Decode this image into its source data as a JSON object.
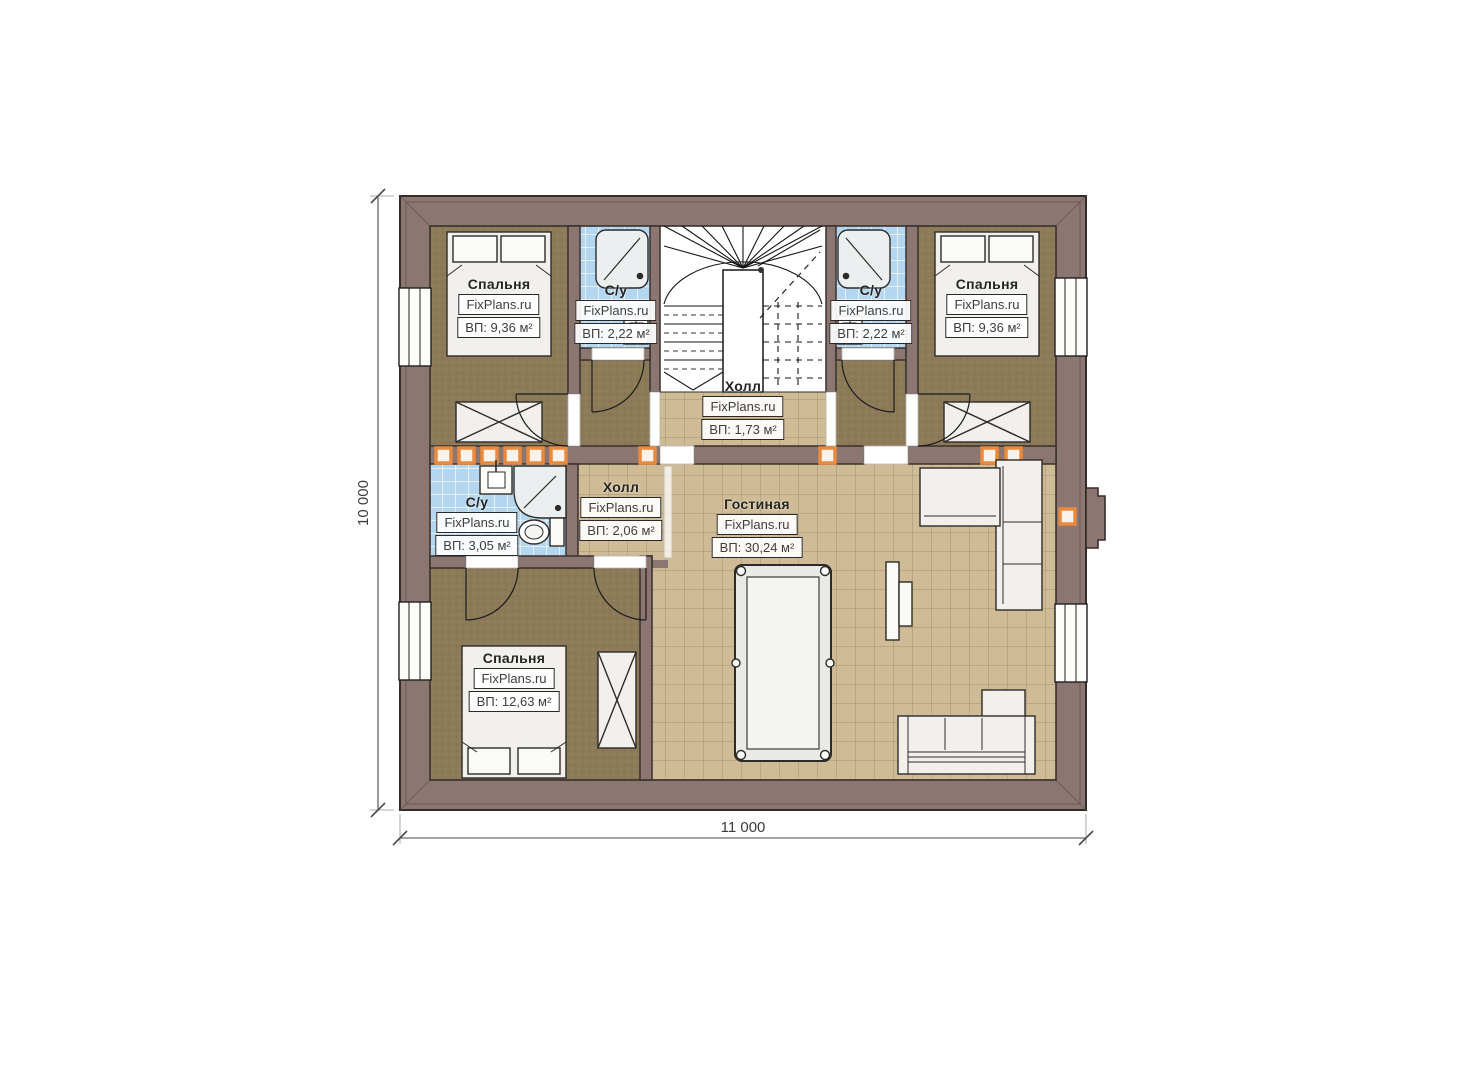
{
  "title": "Floor plan — second level",
  "watermark": "FixPlans.ru",
  "dimensions": {
    "width_label": "11 000",
    "height_label": "10 000"
  },
  "colors": {
    "wall": "#8b7672",
    "wall_outline": "#352c29",
    "bedroom_floor": "#8d7a59",
    "tile_floor": "#cfbc96",
    "tile_grid": "#a6926d",
    "bath_floor": "#b4d7ef",
    "accent_orange": "#e98a3c",
    "furniture": "#f1f0ec",
    "dim_text": "#3c3c3c"
  },
  "rooms": [
    {
      "id": "bedroom-tl",
      "name": "Спальня",
      "area": "ВП: 9,36 м²"
    },
    {
      "id": "bath-tl",
      "name": "С/у",
      "area": "ВП: 2,22 м²"
    },
    {
      "id": "stair-hall",
      "name": "Холл",
      "area": "ВП: 1,73 м²"
    },
    {
      "id": "bath-tr",
      "name": "С/у",
      "area": "ВП: 2,22 м²"
    },
    {
      "id": "bedroom-tr",
      "name": "Спальня",
      "area": "ВП: 9,36 м²"
    },
    {
      "id": "bath-ml",
      "name": "С/у",
      "area": "ВП: 3,05 м²"
    },
    {
      "id": "hall",
      "name": "Холл",
      "area": "ВП: 2,06 м²"
    },
    {
      "id": "living",
      "name": "Гостиная",
      "area": "ВП: 30,24 м²"
    },
    {
      "id": "bedroom-bl",
      "name": "Спальня",
      "area": "ВП: 12,63 м²"
    }
  ]
}
